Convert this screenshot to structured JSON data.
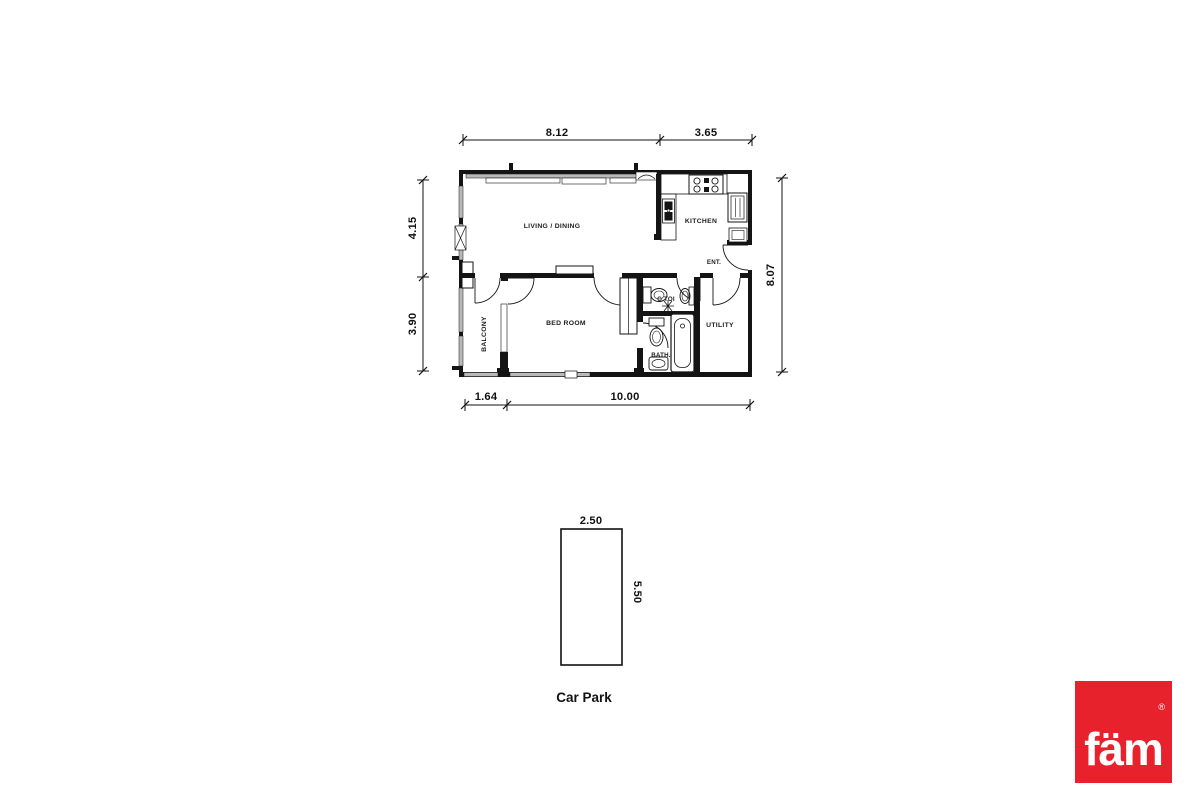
{
  "plan": {
    "rooms": {
      "living_dining": "LIVING / DINING",
      "kitchen": "KITCHEN",
      "bed_room": "BED ROOM",
      "balcony": "BALCONY",
      "entrance": "ENT.",
      "guest_toilet": "G.TOI",
      "bath": "BATH.",
      "utility": "UTILITY"
    },
    "dims": {
      "top_living": "8.12",
      "top_kitchen": "3.65",
      "left_upper": "4.15",
      "left_lower": "3.90",
      "right_total": "8.07",
      "bottom_balcony": "1.64",
      "bottom_main": "10.00"
    }
  },
  "car_park": {
    "title": "Car Park",
    "dim_width": "2.50",
    "dim_length": "5.50"
  },
  "brand": {
    "logo_text": "fäm",
    "registered": "®",
    "logo_color": "#e8222d"
  }
}
